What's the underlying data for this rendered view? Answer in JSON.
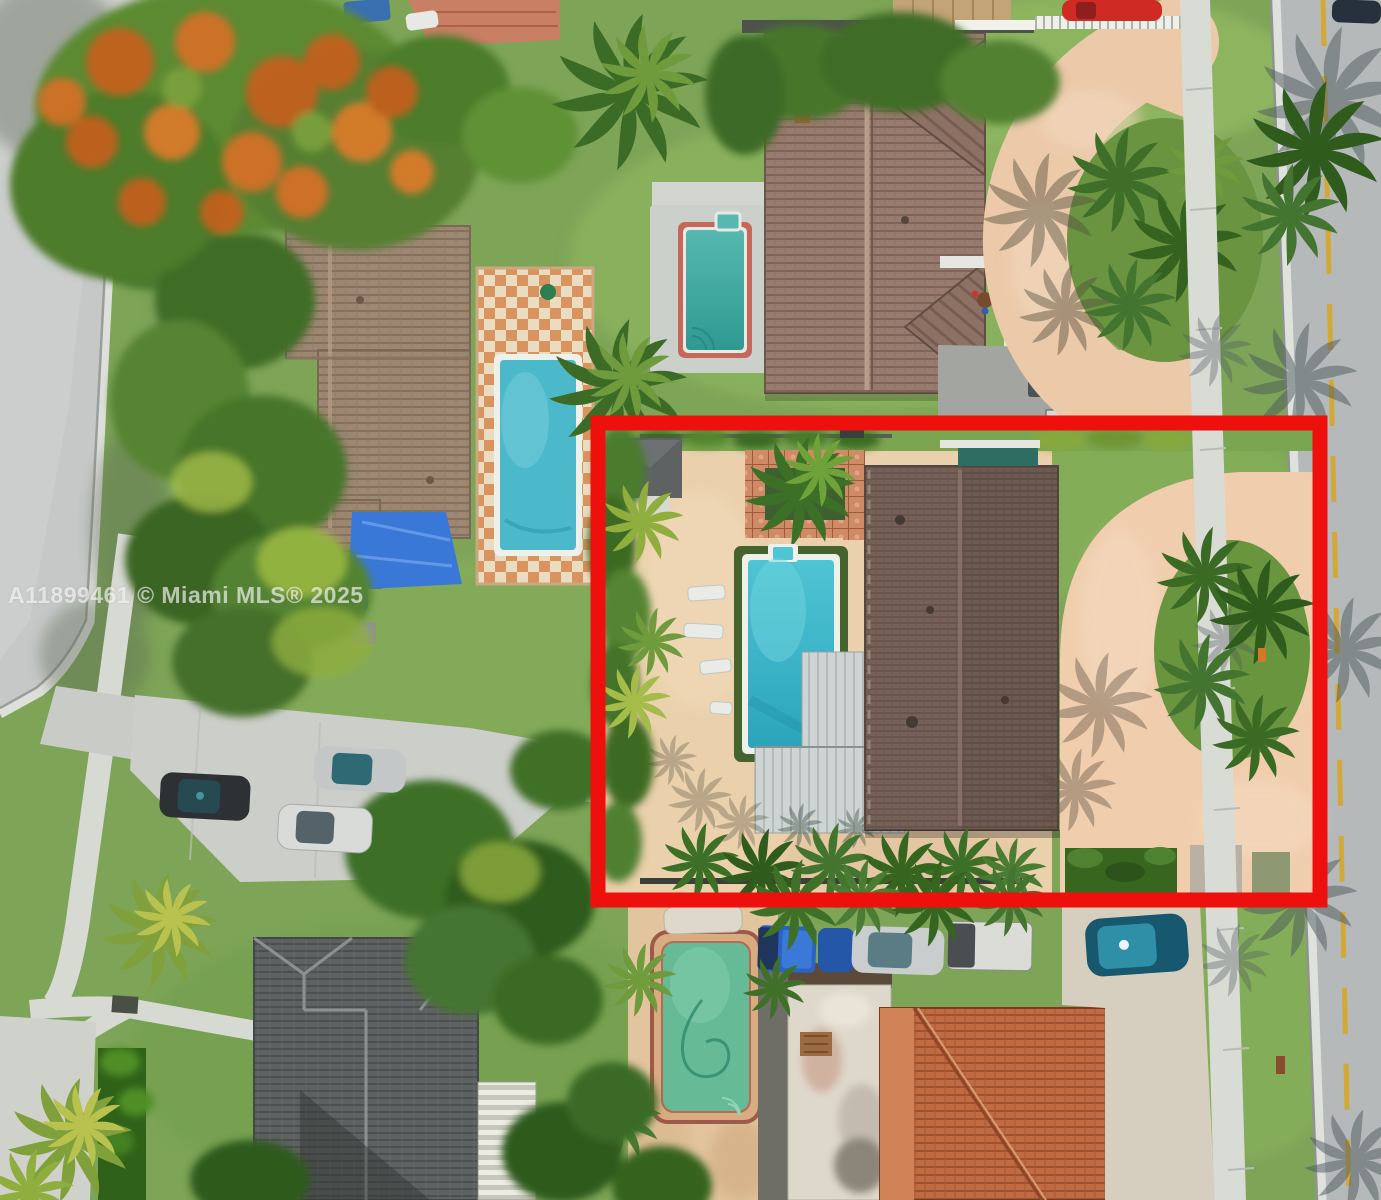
{
  "image": {
    "kind": "aerial-drone-real-estate-photo",
    "description": "Top-down aerial view of a suburban Miami block with five residential lots, pools, palm trees, parked cars, a street on the left and a street on the right; one lot is outlined with a thick red rectangle.",
    "width_px": 1381,
    "height_px": 1200
  },
  "watermark": {
    "text": "A11899461 © Miami MLS® 2025",
    "color": "#ffffff",
    "opacity": 0.62
  },
  "highlight_box": {
    "shape": "rectangle",
    "color": "#ee100d",
    "stroke_px": 15,
    "x": 598,
    "y": 423,
    "width": 722,
    "height": 477
  },
  "colors": {
    "highlight_red": "#ee100d",
    "grass": "#7da457",
    "road_left": "#c6c8c7",
    "road_right": "#b6b9ba",
    "sidewalk": "#d9dbd5",
    "subject_pool_turquoise": "#41bccd",
    "neighbor_pool_teal": "#4cb9ca",
    "small_pool_teal_green": "#4fb5ac",
    "bottom_pool_green": "#66bb96",
    "subject_roof_brown": "#766158",
    "big_roof_mauve": "#977b6e",
    "neighbor_roof_taupe": "#9d8773",
    "gray_roof": "#5e6162",
    "orange_tile_roof": "#c06b43",
    "metal_roof_gray": "#ced4d3",
    "paver_tan": "#ead0ab",
    "paver_pink": "#efcdad",
    "checker_patio_orange": "#d8935f",
    "tarp_blue": "#3a78d8",
    "poinciana_orange": "#c85f1d",
    "yellow_road_line": "#d8a61f"
  },
  "scene": {
    "streets": [
      {
        "name": "left-street",
        "position": "runs diagonally down the left edge",
        "features": [
          "concrete sidewalk",
          "driveway aprons",
          "tree shadows"
        ]
      },
      {
        "name": "right-street",
        "position": "vertical along right edge",
        "features": [
          "double yellow center line",
          "white curb",
          "palm frond shadows",
          "parallel public sidewalk"
        ]
      }
    ],
    "subject_property": {
      "outlined_in_red": true,
      "features": [
        "rectangular turquoise pool with spa notch and white coping",
        "artificial turf pool surround",
        "four white lounge chairs",
        "light gray standing-seam metal roof section",
        "large dark brown tile roof",
        "tan paver pool deck",
        "pink paver circular driveway",
        "grass island with cluster of palms",
        "brick paver patio with palm",
        "small gray shed",
        "perimeter hedges and palms"
      ]
    },
    "neighboring_properties": [
      {
        "location": "upper-left",
        "features": [
          "taupe tile roof house",
          "teal pool with white border",
          "orange-and-white checkerboard patio",
          "blue tarp",
          "royal poinciana tree with orange blooms"
        ]
      },
      {
        "location": "top-center",
        "features": [
          "large mauve tile roof with two east gables",
          "small teal-green pool with coral tile border",
          "white picket fence",
          "curved tan driveway",
          "trash bins",
          "basketball hoop"
        ]
      },
      {
        "location": "bottom-left",
        "features": [
          "dark gray shingle hip roof",
          "white striped lanai roof",
          "curved sidewalk",
          "bright green hedge",
          "yellow-green palms"
        ]
      },
      {
        "location": "bottom-center",
        "features": [
          "green-water pool with red brick coping",
          "weathered white flat roof",
          "orange barrel tile roof",
          "row of parked vehicles"
        ]
      }
    ],
    "vehicles": [
      {
        "name": "red-car",
        "location": "top edge near right street"
      },
      {
        "name": "dark-car",
        "location": "top right corner on road"
      },
      {
        "name": "dark-suv",
        "location": "left parking pad"
      },
      {
        "name": "white-minivan",
        "location": "left parking pad"
      },
      {
        "name": "silver-car-teal-glass",
        "location": "left parking pad"
      },
      {
        "name": "blue-pickup",
        "location": "row below red box"
      },
      {
        "name": "blue-sedan",
        "location": "row below red box"
      },
      {
        "name": "silver-wagon",
        "location": "row below red box"
      },
      {
        "name": "white-pickup",
        "location": "row below red box"
      },
      {
        "name": "teal-hatchback",
        "location": "driveway bottom right"
      }
    ]
  }
}
